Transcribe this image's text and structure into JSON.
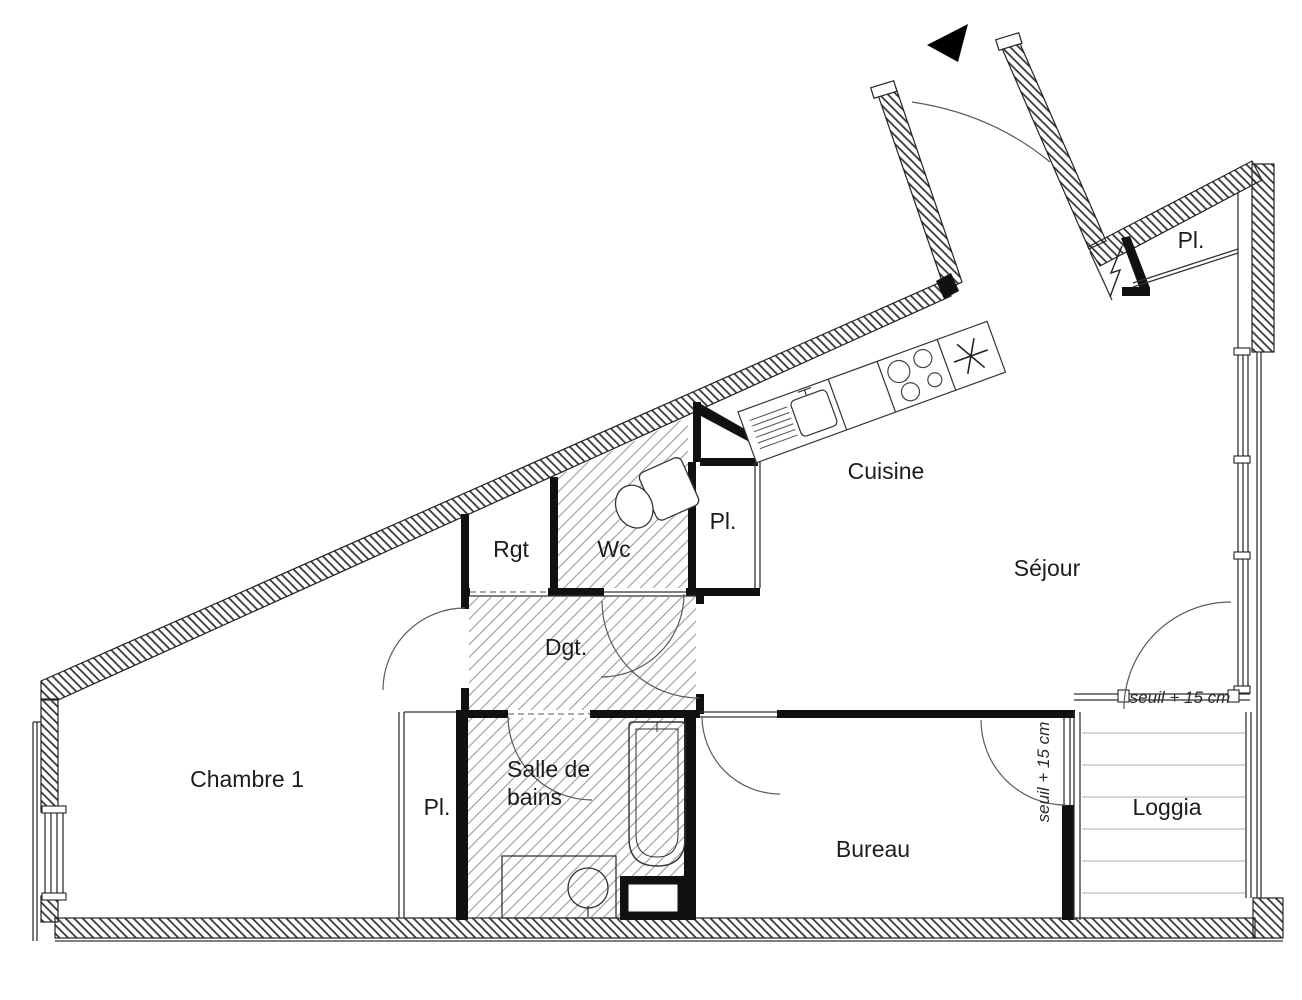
{
  "drawing": {
    "type": "apartment-floor-plan",
    "rooms": {
      "chambre1": "Chambre 1",
      "salle_de_bains_l1": "Salle de",
      "salle_de_bains_l2": "bains",
      "degagement": "Dgt.",
      "rangement": "Rgt",
      "wc": "Wc",
      "cuisine": "Cuisine",
      "sejour": "Séjour",
      "bureau": "Bureau",
      "loggia": "Loggia",
      "placard_chambre": "Pl.",
      "placard_couloir": "Pl.",
      "placard_entree": "Pl."
    },
    "annotations": {
      "seuil_sejour_loggia": "seuil + 15 cm",
      "seuil_bureau_loggia": "seuil + 15 cm"
    },
    "icons": {
      "north_arrow": "filled-triangle",
      "electrical_panel": "lightning-bolt",
      "kitchen_appliance_star": "asterisk"
    },
    "colors": {
      "wall_hatch": "#2f2f2f",
      "floor_hatch": "#9b9b9b",
      "line": "#222222",
      "light_line": "#c9c9c9",
      "solid_wall": "#111111"
    }
  }
}
